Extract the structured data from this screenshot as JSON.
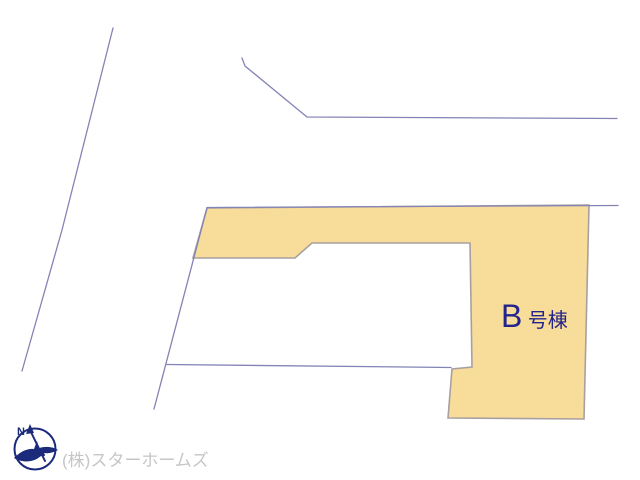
{
  "site_plan": {
    "building_label": {
      "prefix": "B",
      "suffix": "号棟"
    },
    "company_credit": "(株)スターホームズ",
    "compass": {
      "north_label": "N"
    },
    "colors": {
      "parcel_fill": "#F8DC9A",
      "parcel_outline": "#A8A0A0",
      "boundary_line": "#8383B6",
      "label_navy": "#23238C",
      "credit_gray": "#C6C6C6",
      "logo_navy": "#1B2A7B"
    }
  }
}
